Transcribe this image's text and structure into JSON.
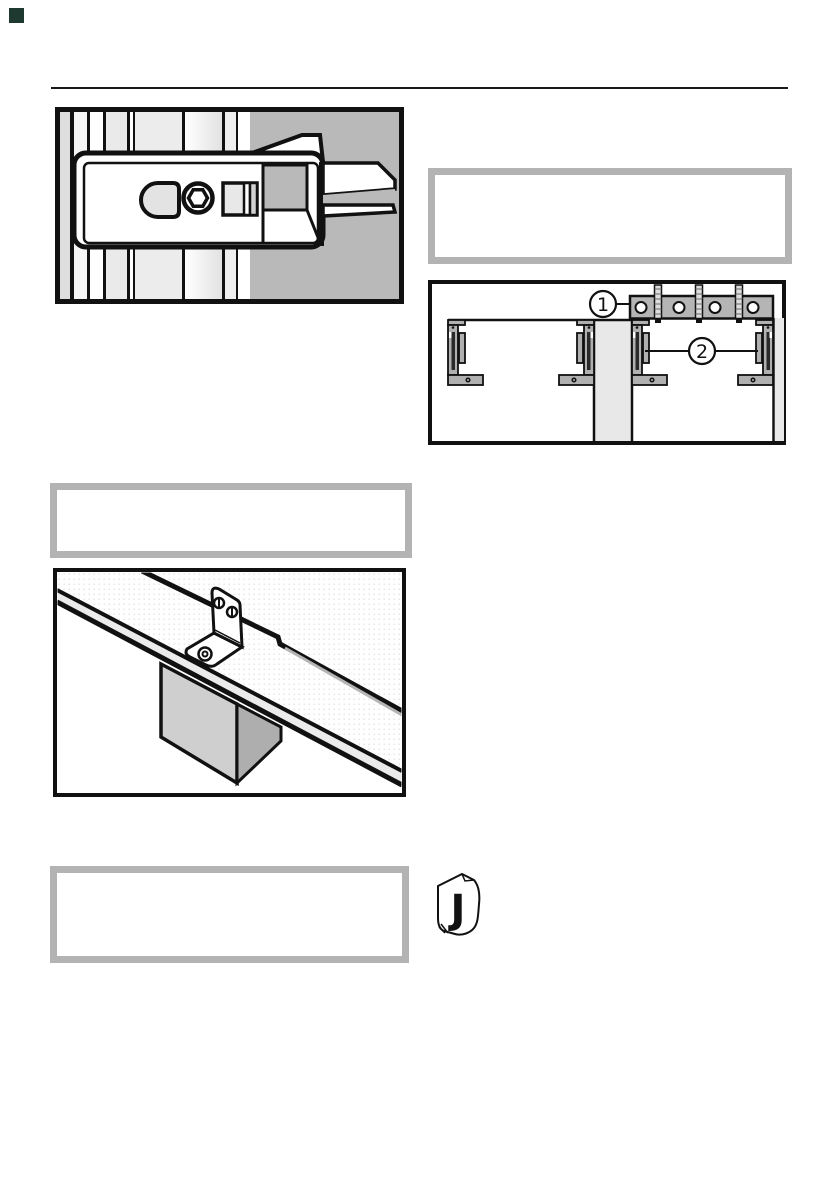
{
  "page": {
    "background_color": "#ffffff",
    "corner_mark_color": "#1e3a30",
    "header_rule_color": "#1a1a1a",
    "line_art_color": "#111111"
  },
  "notice_boxes": {
    "border_color": "#b3b3b3",
    "box1_text": "",
    "box2_text": "",
    "box3_text": ""
  },
  "figures": {
    "latch_assembly": {
      "side_panel_gray": "#b9b9b9",
      "slot_gray": "#e3e3e3"
    },
    "mounting_brackets": {
      "callout_1": "1",
      "callout_2": "2",
      "rail_gray": "#b5b5b5",
      "bracket_gray": "#b0b0b0",
      "wall_gray": "#e8e8e8"
    },
    "angle_bracket": {
      "worktop_edge_gray": "#ebebeb",
      "block_front_gray": "#cfcfcf",
      "block_side_gray": "#aeaeae"
    },
    "parts_bag": {
      "label": "J"
    }
  }
}
